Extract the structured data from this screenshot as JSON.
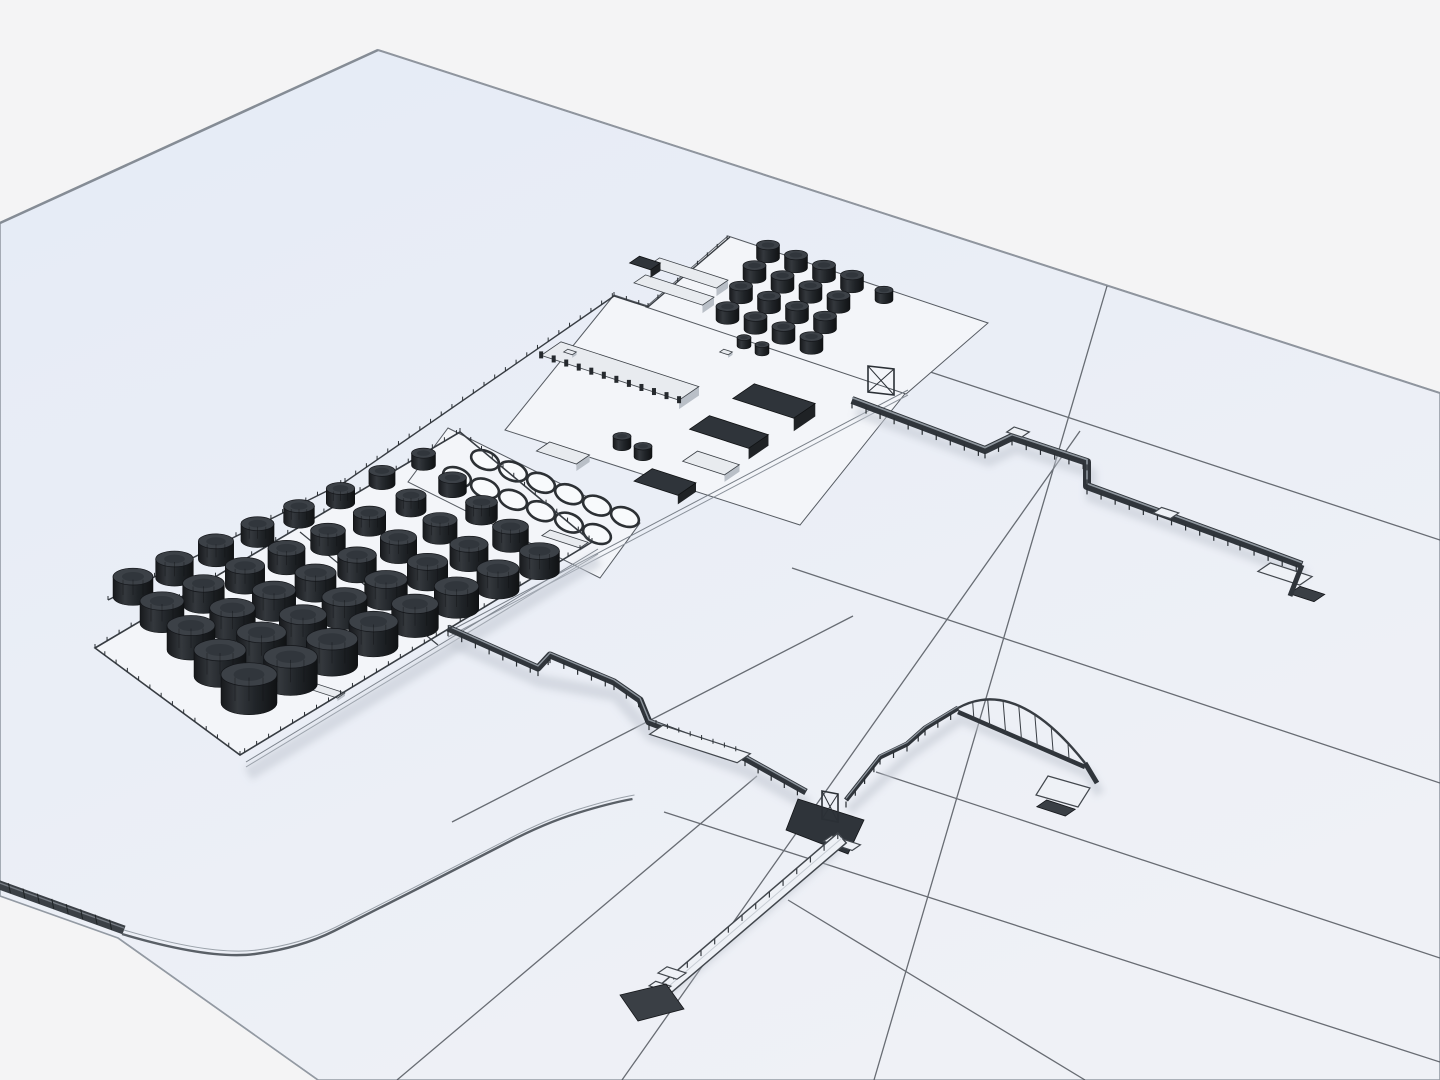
{
  "scene": {
    "description": "3D wireframe-style render of an oil storage terminal and tank farm on a pale blue ground plane with large grid panels; two elevated pipeline trestles run to jetty platforms (one east with a zigzag, one south-east with an arched bridge branch and a long white causeway pier); shoreline seawall at lower left; no text in image",
    "size": {
      "w": 1440,
      "h": 1080
    },
    "counts": {
      "farm_tanks": 40,
      "top_cluster_tanks": 17,
      "ring_foundations": 12
    },
    "colors": {
      "background": "#f4f4f5",
      "plane_top": "#e5ebf6",
      "plane_bottom": "#eff1f6",
      "plane_edge": "#939aa3",
      "grid_line": "#474c53",
      "parcel_floor": "#f3f5f9",
      "fence": "#383d43",
      "rack_dark": "#30353b",
      "rack_highlight": "#9aa2ab",
      "deck_light": "#eef1f6",
      "tank_body_dark": "#1b1e21",
      "tank_body_mid": "#34383d",
      "tank_top": "#3c4147",
      "building_dark_top": "#2f343a",
      "building_dark_side": "#17191c",
      "building_light_top": "#e8ebef",
      "building_light_side": "#a9b0b8",
      "shadow": "#c3c9d2",
      "seawall": "#3b4046",
      "shore_line": "#5a6067"
    },
    "ground": {
      "outline": [
        [
          378,
          50
        ],
        [
          1440,
          393
        ],
        [
          1440,
          1080
        ],
        [
          318,
          1080
        ],
        [
          118,
          938
        ],
        [
          0,
          896
        ],
        [
          0,
          223
        ]
      ],
      "edge_left": [
        [
          378,
          50
        ],
        [
          0,
          223
        ]
      ],
      "edge_right": [
        [
          378,
          50
        ],
        [
          1440,
          393
        ]
      ],
      "corner_edge": [
        [
          118,
          938
        ],
        [
          318,
          1080
        ]
      ],
      "grid_a": [
        [
          900,
          362,
          1440,
          540
        ],
        [
          792,
          568,
          1440,
          783
        ],
        [
          876,
          772,
          1440,
          958
        ],
        [
          664,
          812,
          1440,
          1062
        ],
        [
          788,
          900,
          1085,
          1080
        ]
      ],
      "grid_l": [
        [
          1107,
          286,
          874,
          1080
        ],
        [
          1080,
          431,
          622,
          1080
        ],
        [
          757,
          776,
          397,
          1080
        ],
        [
          853,
          616,
          452,
          822
        ]
      ],
      "seawall": {
        "from": [
          -6,
          883
        ],
        "to": [
          124,
          930
        ],
        "width": 9,
        "ticks": 9
      },
      "shore_curve": [
        [
          122,
          934
        ],
        [
          210,
          960
        ],
        [
          300,
          948
        ],
        [
          368,
          914
        ],
        [
          470,
          862
        ],
        [
          545,
          823
        ],
        [
          610,
          803
        ],
        [
          655,
          795
        ]
      ]
    },
    "parcels": {
      "farm": [
        [
          95,
          648
        ],
        [
          460,
          432
        ],
        [
          592,
          542
        ],
        [
          240,
          755
        ]
      ],
      "circles": [
        [
          448,
          428
        ],
        [
          640,
          523
        ],
        [
          600,
          578
        ],
        [
          408,
          482
        ]
      ],
      "middle": [
        [
          505,
          430
        ],
        [
          614,
          295
        ],
        [
          908,
          390
        ],
        [
          800,
          525
        ]
      ],
      "top": [
        [
          728,
          236
        ],
        [
          988,
          323
        ],
        [
          906,
          394
        ],
        [
          646,
          307
        ]
      ]
    },
    "fences": {
      "nw_boundary": [
        [
          108,
          600
        ],
        [
          345,
          482
        ],
        [
          614,
          296
        ]
      ],
      "nw_boundary2": [
        [
          614,
          296
        ],
        [
          648,
          307
        ],
        [
          730,
          237
        ]
      ],
      "farm_divider": [
        [
          300,
          532
        ],
        [
          438,
          645
        ]
      ],
      "se_road": [
        [
          448,
          632
        ],
        [
          908,
          390
        ]
      ],
      "farm_se_road": [
        [
          246,
          762
        ],
        [
          598,
          549
        ]
      ]
    },
    "circle_field": {
      "rows": 2,
      "cols": 6,
      "row_starts": [
        [
          485,
          460
        ],
        [
          457,
          477
        ]
      ],
      "u": [
        28,
        11.4
      ],
      "rx": 14.5,
      "ry": 9,
      "rotation": 22
    },
    "tank_farm": {
      "rows": 5,
      "cols": 8,
      "origin": [
        133,
        597
      ],
      "u": [
        41.5,
        -18.8
      ],
      "v": [
        29,
        26.5
      ],
      "r_base": 24,
      "r_col": 1.15,
      "r_row": 2.0,
      "r_min": 12,
      "r_max": 28
    },
    "top_cluster": {
      "rows": 4,
      "cols": 4,
      "origin": [
        768,
        258
      ],
      "u": [
        28,
        10
      ],
      "v": [
        -13.5,
        20.5
      ],
      "r": 11.5,
      "h": 13,
      "extra": [
        884,
        300,
        9,
        10
      ]
    },
    "axes": {
      "p": [
        0.951,
        0.309
      ],
      "q": [
        0.825,
        -0.565
      ]
    },
    "buildings": [
      {
        "name": "ribbed-warehouse",
        "c": [
          620,
          371
        ],
        "L": 145,
        "W": 24,
        "h": 9,
        "type": "light",
        "ribs": 12
      },
      {
        "name": "dark-building-1",
        "c": [
          774,
          401
        ],
        "L": 64,
        "W": 26,
        "h": 13,
        "type": "dark"
      },
      {
        "name": "dark-building-2",
        "c": [
          729,
          432
        ],
        "L": 62,
        "W": 24,
        "h": 11,
        "type": "dark"
      },
      {
        "name": "light-building-1",
        "c": [
          711,
          463
        ],
        "L": 44,
        "W": 18,
        "h": 7,
        "type": "light"
      },
      {
        "name": "light-building-2",
        "c": [
          563,
          453
        ],
        "L": 42,
        "W": 16,
        "h": 7,
        "type": "light"
      },
      {
        "name": "dark-building-3",
        "c": [
          665,
          482
        ],
        "L": 46,
        "W": 22,
        "h": 9,
        "type": "dark"
      },
      {
        "name": "warehouse-north-1",
        "c": [
          688,
          273
        ],
        "L": 72,
        "W": 14,
        "h": 8,
        "type": "light"
      },
      {
        "name": "warehouse-north-2",
        "c": [
          674,
          290
        ],
        "L": 72,
        "W": 14,
        "h": 8,
        "type": "light"
      },
      {
        "name": "dark-shed-north",
        "c": [
          645,
          263
        ],
        "L": 22,
        "W": 12,
        "h": 8,
        "type": "dark"
      },
      {
        "name": "white-bar-1",
        "c": [
          565,
          539
        ],
        "L": 40,
        "W": 10,
        "h": 3,
        "type": "light"
      },
      {
        "name": "white-bar-2",
        "c": [
          324,
          690
        ],
        "L": 36,
        "W": 9,
        "h": 3,
        "type": "light"
      },
      {
        "name": "truck-1",
        "c": [
          726,
          352
        ],
        "L": 9,
        "W": 5,
        "h": 3,
        "type": "light"
      },
      {
        "name": "truck-2",
        "c": [
          570,
          352
        ],
        "L": 9,
        "W": 5,
        "h": 3,
        "type": "light"
      }
    ],
    "small_tanks": [
      [
        622,
        447,
        9
      ],
      [
        643,
        457,
        9
      ],
      [
        744,
        346,
        7
      ],
      [
        762,
        353,
        7
      ]
    ],
    "piers": {
      "east": {
        "path": [
          [
            852,
            400
          ],
          [
            985,
            450
          ],
          [
            1012,
            437
          ],
          [
            1087,
            462
          ],
          [
            1087,
            486
          ],
          [
            1240,
            542
          ],
          [
            1302,
            565
          ]
        ],
        "width": 8,
        "gate": [
          868,
          366,
          26,
          26
        ],
        "boxes": [
          [
            1018,
            432,
            16,
            9
          ],
          [
            1166,
            513,
            18,
            10
          ]
        ],
        "deck": {
          "c": [
            1285,
            574
          ],
          "L": 44,
          "W": 15
        },
        "pad": {
          "c": [
            1307,
            594
          ],
          "L": 26,
          "W": 13
        },
        "tail": [
          [
            1302,
            565
          ],
          [
            1290,
            596
          ]
        ]
      },
      "south": {
        "path": [
          [
            448,
            628
          ],
          [
            538,
            668
          ],
          [
            550,
            655
          ],
          [
            614,
            682
          ],
          [
            640,
            700
          ],
          [
            649,
            722
          ],
          [
            745,
            758
          ],
          [
            806,
            792
          ]
        ],
        "width": 7,
        "platform": {
          "c": [
            700,
            744
          ],
          "L": 92,
          "W": 16
        },
        "junction": {
          "poly": [
            [
              798,
              799
            ],
            [
              864,
              820
            ],
            [
              848,
              854
            ],
            [
              786,
              830
            ]
          ],
          "tower": [
            822,
            791,
            16,
            28
          ],
          "deck": {
            "c": [
              842,
              843
            ],
            "L": 30,
            "W": 10
          }
        }
      },
      "causeway": {
        "from": [
          842,
          838
        ],
        "to": [
          662,
          992
        ],
        "width": 13,
        "spur": {
          "c": [
            672,
            973
          ],
          "L": 20,
          "W": 11
        },
        "pad": [
          [
            620,
            995
          ],
          [
            666,
            984
          ],
          [
            684,
            1009
          ],
          [
            638,
            1021
          ]
        ],
        "step": {
          "c": [
            660,
            986
          ],
          "L": 16,
          "W": 8
        }
      },
      "arch": {
        "approach": [
          [
            846,
            800
          ],
          [
            880,
            757
          ],
          [
            907,
            744
          ],
          [
            925,
            728
          ],
          [
            958,
            708
          ]
        ],
        "span": {
          "from": [
            958,
            708
          ],
          "to": [
            1085,
            763
          ],
          "ctrl": [
            1016,
            676
          ],
          "hangers": 7
        },
        "tail": [
          [
            1085,
            763
          ],
          [
            1097,
            783
          ]
        ],
        "platform": [
          [
            1048,
            776
          ],
          [
            1090,
            788
          ],
          [
            1078,
            807
          ],
          [
            1036,
            795
          ]
        ],
        "pad": {
          "c": [
            1056,
            808
          ],
          "L": 30,
          "W": 12
        }
      }
    },
    "shadows": [
      {
        "pts": [
          [
            852,
            400
          ],
          [
            985,
            450
          ],
          [
            1012,
            437
          ],
          [
            1087,
            462
          ],
          [
            1087,
            486
          ],
          [
            1240,
            542
          ],
          [
            1302,
            565
          ]
        ],
        "w": 11,
        "dx": 4,
        "dy": 11
      },
      {
        "pts": [
          [
            448,
            628
          ],
          [
            538,
            668
          ],
          [
            614,
            682
          ],
          [
            649,
            722
          ],
          [
            745,
            758
          ],
          [
            806,
            792
          ]
        ],
        "w": 13,
        "dx": 2,
        "dy": 13
      },
      {
        "pts": [
          [
            842,
            838
          ],
          [
            662,
            992
          ]
        ],
        "w": 11,
        "dx": -4,
        "dy": 9
      },
      {
        "pts": [
          [
            846,
            800
          ],
          [
            907,
            744
          ],
          [
            958,
            708
          ],
          [
            1085,
            763
          ],
          [
            1097,
            783
          ]
        ],
        "w": 10,
        "dx": 3,
        "dy": 11
      },
      {
        "pts": [
          [
            245,
            765
          ],
          [
            595,
            550
          ]
        ],
        "w": 14,
        "dx": 3,
        "dy": 9
      }
    ]
  }
}
